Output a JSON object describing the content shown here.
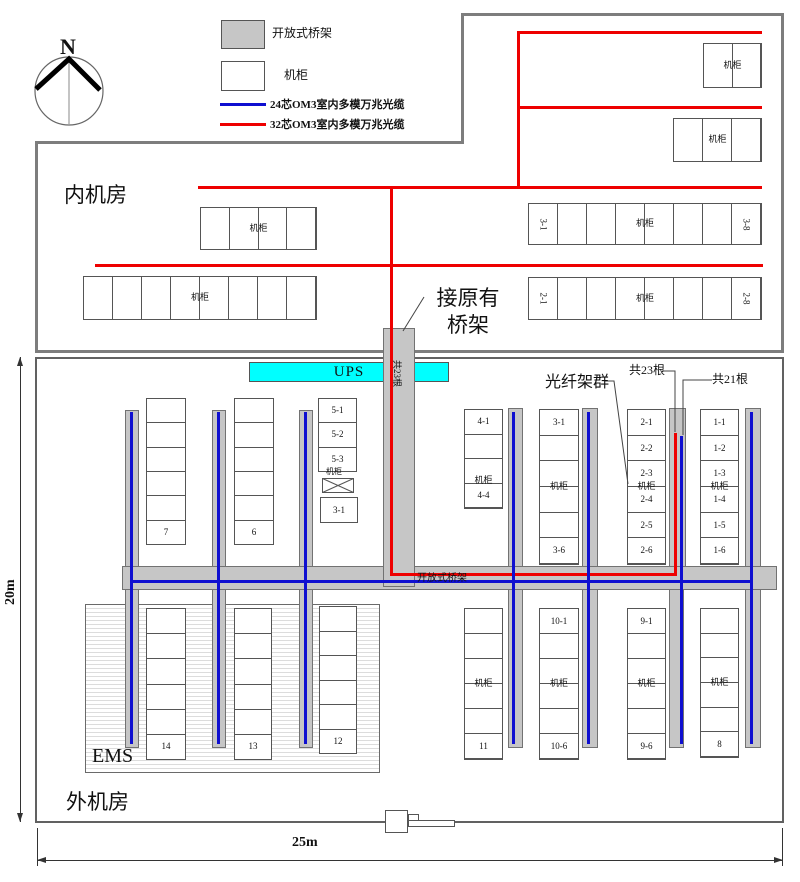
{
  "legend": {
    "items": [
      {
        "name": "open-tray",
        "label": "开放式桥架"
      },
      {
        "name": "cabinet",
        "label": "机柜"
      },
      {
        "name": "blue-cable",
        "label": "24芯OM3室内多模万兆光缆"
      },
      {
        "name": "red-cable",
        "label": "32芯OM3室内多模万兆光缆"
      }
    ]
  },
  "compass": {
    "north": "N"
  },
  "rooms": {
    "inner": "内机房",
    "outer": "外机房"
  },
  "ups": {
    "label": "UPS"
  },
  "ems": {
    "label": "EMS"
  },
  "annotations": {
    "connect_tray_line1": "接原有",
    "connect_tray_line2": "桥架",
    "tray_count_vertical": "共23根",
    "fiber_group": "光纤架群",
    "count_23": "共23根",
    "count_21": "共21根",
    "open_tray_band": "开放式桥架"
  },
  "dimensions": {
    "horizontal": "25m",
    "vertical": "20m"
  },
  "special": {
    "box_3_1": "3-1",
    "mini_cabinet_label": "机柜"
  },
  "cabinet_groups": [
    {
      "name": "top-right-2",
      "x": 703,
      "y": 43,
      "w": 59,
      "h": 45,
      "dir": "h",
      "cells": [
        "",
        ""
      ],
      "mid": "机柜"
    },
    {
      "name": "top-right-3",
      "x": 673,
      "y": 118,
      "w": 89,
      "h": 44,
      "dir": "h",
      "cells": [
        "",
        "",
        ""
      ],
      "mid": "机柜"
    },
    {
      "name": "inner-left-4",
      "x": 200,
      "y": 207,
      "w": 117,
      "h": 43,
      "dir": "h",
      "cells": [
        "",
        "",
        "",
        ""
      ],
      "mid": "机柜"
    },
    {
      "name": "inner-row-3",
      "x": 528,
      "y": 203,
      "w": 234,
      "h": 42,
      "dir": "h",
      "rot": true,
      "cells": [
        "3-1",
        "",
        "",
        "",
        "",
        "",
        "",
        "3-8"
      ],
      "mid": "机柜"
    },
    {
      "name": "inner-left-8",
      "x": 83,
      "y": 276,
      "w": 234,
      "h": 44,
      "dir": "h",
      "cells": [
        "",
        "",
        "",
        "",
        "",
        "",
        "",
        ""
      ],
      "mid": "机柜"
    },
    {
      "name": "inner-row-2",
      "x": 528,
      "y": 277,
      "w": 234,
      "h": 43,
      "dir": "h",
      "rot": true,
      "cells": [
        "2-1",
        "",
        "",
        "",
        "",
        "",
        "",
        "2-8"
      ],
      "mid": "机柜"
    },
    {
      "name": "col-7",
      "x": 146,
      "y": 398,
      "w": 40,
      "h": 147,
      "dir": "v",
      "cells": [
        "",
        "",
        "",
        "",
        "",
        "7"
      ]
    },
    {
      "name": "col-6",
      "x": 234,
      "y": 398,
      "w": 40,
      "h": 147,
      "dir": "v",
      "cells": [
        "",
        "",
        "",
        "",
        "",
        "6"
      ]
    },
    {
      "name": "col-5",
      "x": 318,
      "y": 398,
      "w": 39,
      "h": 74,
      "dir": "v",
      "cells": [
        "5-1",
        "5-2",
        "5-3"
      ]
    },
    {
      "name": "col-4",
      "x": 464,
      "y": 409,
      "w": 39,
      "h": 100,
      "dir": "v",
      "cells": [
        "4-1",
        "",
        "",
        "4-4"
      ],
      "mid": "机柜",
      "midy": 0.72
    },
    {
      "name": "col-3",
      "x": 539,
      "y": 409,
      "w": 40,
      "h": 156,
      "dir": "v",
      "cells": [
        "3-1",
        "",
        "",
        "",
        "",
        "3-6"
      ],
      "mid": "机柜"
    },
    {
      "name": "col-2",
      "x": 627,
      "y": 409,
      "w": 39,
      "h": 156,
      "dir": "v",
      "cells": [
        "2-1",
        "2-2",
        "2-3",
        "2-4",
        "2-5",
        "2-6"
      ],
      "mid": "机柜"
    },
    {
      "name": "col-1",
      "x": 700,
      "y": 409,
      "w": 39,
      "h": 156,
      "dir": "v",
      "cells": [
        "1-1",
        "1-2",
        "1-3",
        "1-4",
        "1-5",
        "1-6"
      ],
      "mid": "机柜"
    },
    {
      "name": "col-14",
      "x": 146,
      "y": 608,
      "w": 40,
      "h": 152,
      "dir": "v",
      "cells": [
        "",
        "",
        "",
        "",
        "",
        "14"
      ]
    },
    {
      "name": "col-13",
      "x": 234,
      "y": 608,
      "w": 38,
      "h": 152,
      "dir": "v",
      "cells": [
        "",
        "",
        "",
        "",
        "",
        "13"
      ]
    },
    {
      "name": "col-12",
      "x": 319,
      "y": 606,
      "w": 38,
      "h": 148,
      "dir": "v",
      "cells": [
        "",
        "",
        "",
        "",
        "",
        "12"
      ]
    },
    {
      "name": "col-11",
      "x": 464,
      "y": 608,
      "w": 39,
      "h": 152,
      "dir": "v",
      "cells": [
        "",
        "",
        "",
        "",
        "",
        "11"
      ],
      "mid": "机柜"
    },
    {
      "name": "col-10",
      "x": 539,
      "y": 608,
      "w": 40,
      "h": 152,
      "dir": "v",
      "cells": [
        "10-1",
        "",
        "",
        "",
        "",
        "10-6"
      ],
      "mid": "机柜"
    },
    {
      "name": "col-9",
      "x": 627,
      "y": 608,
      "w": 39,
      "h": 152,
      "dir": "v",
      "cells": [
        "9-1",
        "",
        "",
        "",
        "",
        "9-6"
      ],
      "mid": "机柜"
    },
    {
      "name": "col-8",
      "x": 700,
      "y": 608,
      "w": 39,
      "h": 150,
      "dir": "v",
      "cells": [
        "",
        "",
        "",
        "",
        "",
        "8"
      ],
      "mid": "机柜"
    }
  ]
}
